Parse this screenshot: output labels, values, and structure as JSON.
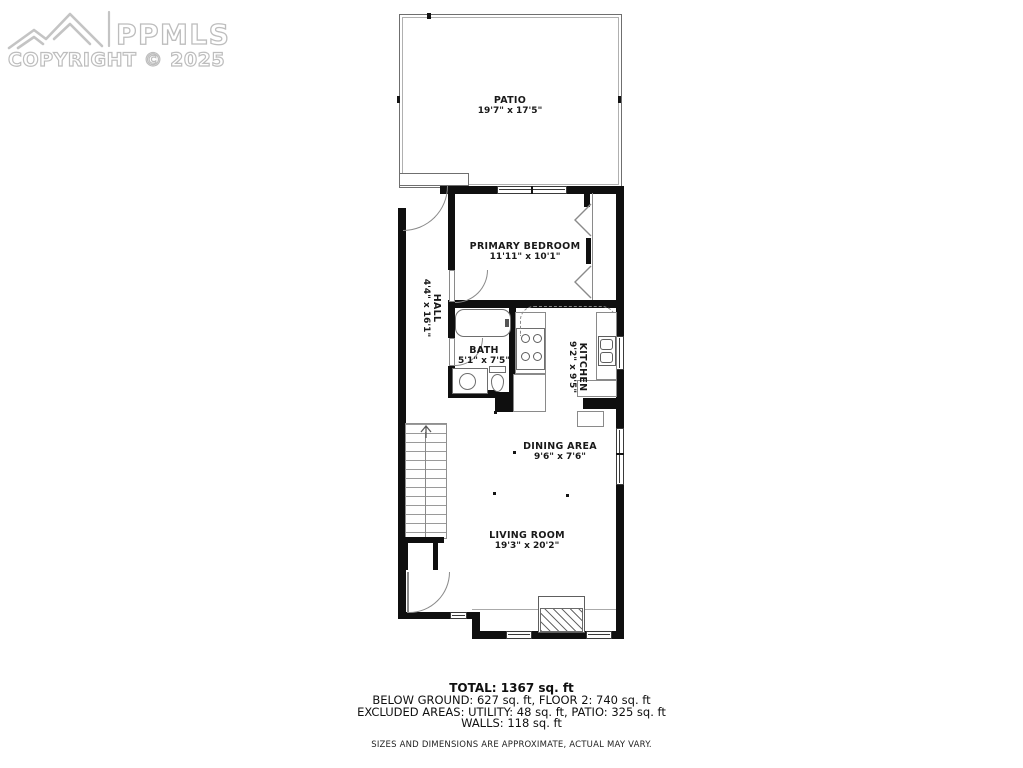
{
  "watermark": {
    "brand": "PPMLS",
    "copyright": "COPYRIGHT © 2025"
  },
  "rooms": {
    "patio": {
      "name": "PATIO",
      "dims": "19'7\" x 17'5\""
    },
    "primary_bedroom": {
      "name": "PRIMARY BEDROOM",
      "dims": "11'11\" x 10'1\""
    },
    "hall": {
      "name": "HALL",
      "dims": "4'4\" x 16'1\""
    },
    "bath": {
      "name": "BATH",
      "dims": "5'1\" x 7'5\""
    },
    "kitchen": {
      "name": "KITCHEN",
      "dims": "9'2\" x 9'5\""
    },
    "dining": {
      "name": "DINING AREA",
      "dims": "9'6\" x 7'6\""
    },
    "living": {
      "name": "LIVING ROOM",
      "dims": "19'3\" x 20'2\""
    }
  },
  "summary": {
    "total": "TOTAL: 1367 sq. ft",
    "areas": "BELOW GROUND: 627 sq. ft, FLOOR 2: 740 sq. ft",
    "excluded": "EXCLUDED AREAS: UTILITY: 48 sq. ft, PATIO: 325 sq. ft",
    "walls": "WALLS: 118 sq. ft",
    "disclaimer": "SIZES AND DIMENSIONS ARE APPROXIMATE, ACTUAL MAY VARY."
  },
  "colors": {
    "wall": "#0f0f0f",
    "thin_line": "#8a8a8a",
    "watermark": "#c4c4c4"
  }
}
